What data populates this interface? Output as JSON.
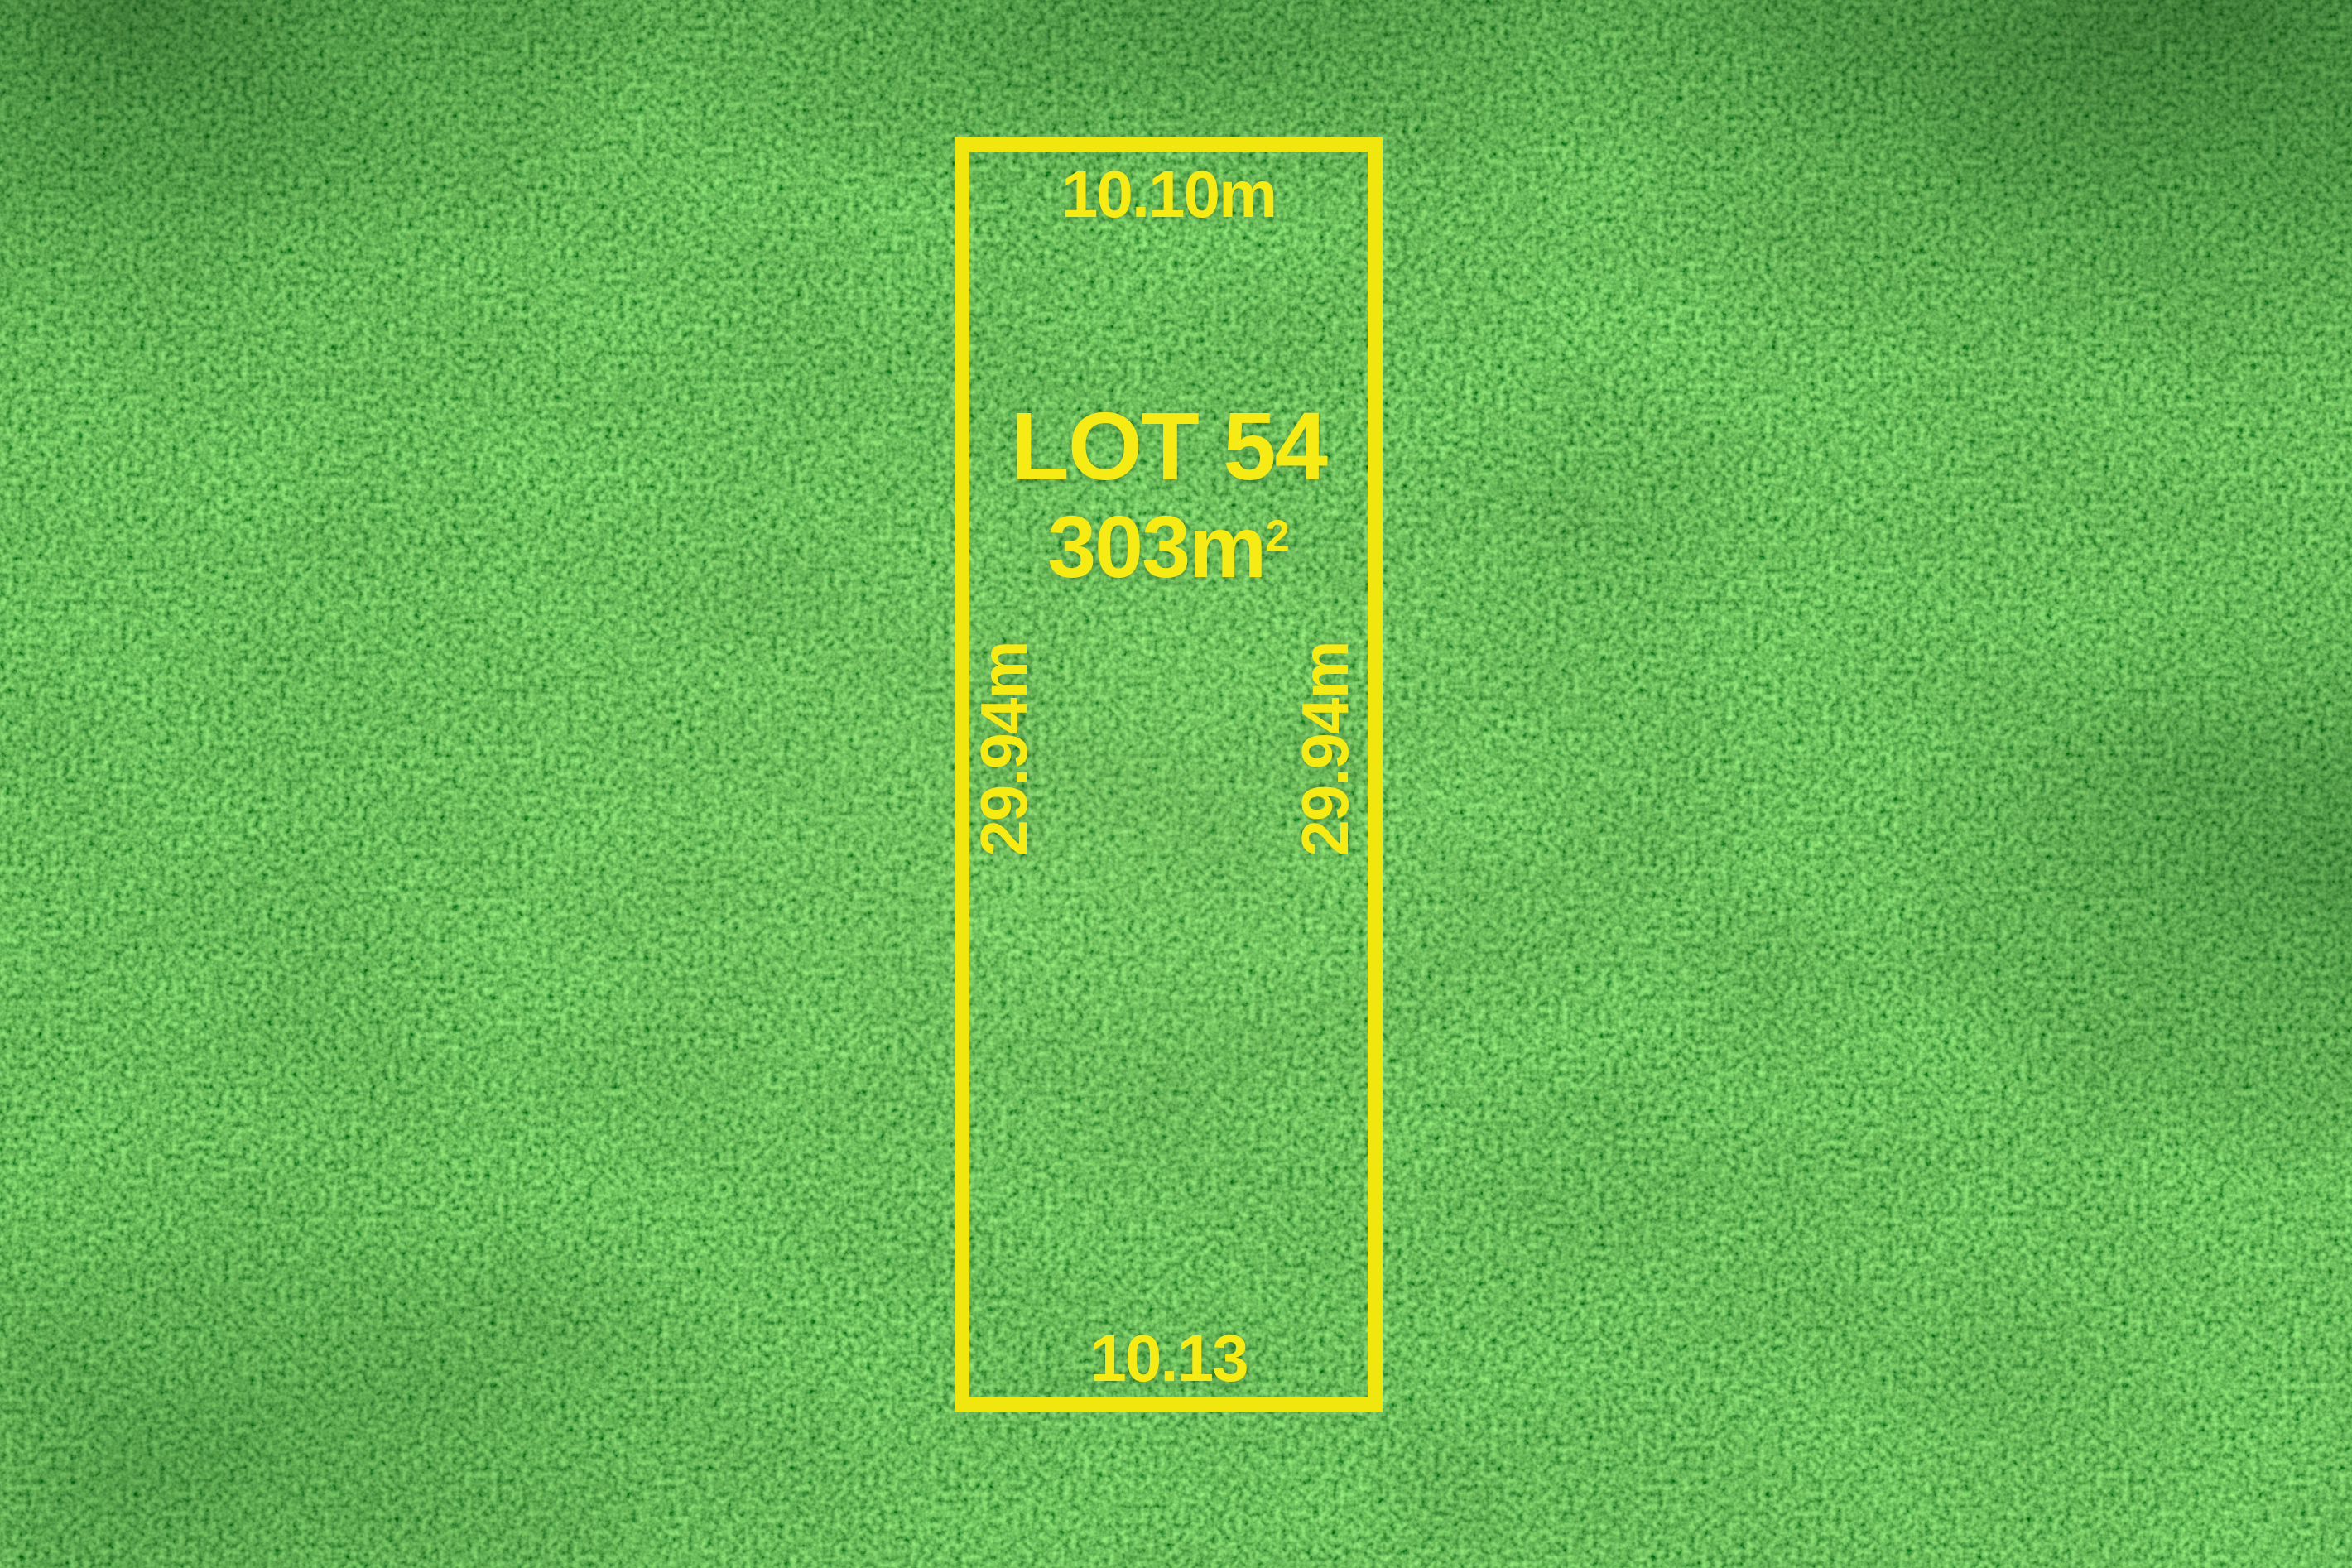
{
  "scene": {
    "description": "Aerial grass photograph with surveyed residential land lot outlined in yellow",
    "colors": {
      "outline_yellow": "#f2e60f",
      "label_yellow": "#f6eb14",
      "grass_mid": "#2a9130",
      "grass_dark": "#0c5418",
      "grass_light": "#6fc23c"
    }
  },
  "lot": {
    "title": "LOT 54",
    "area_value": "303m",
    "area_superscript": "2",
    "dimensions": {
      "top": "10.10m",
      "bottom": "10.13",
      "left": "29.94m",
      "right": "29.94m"
    }
  }
}
